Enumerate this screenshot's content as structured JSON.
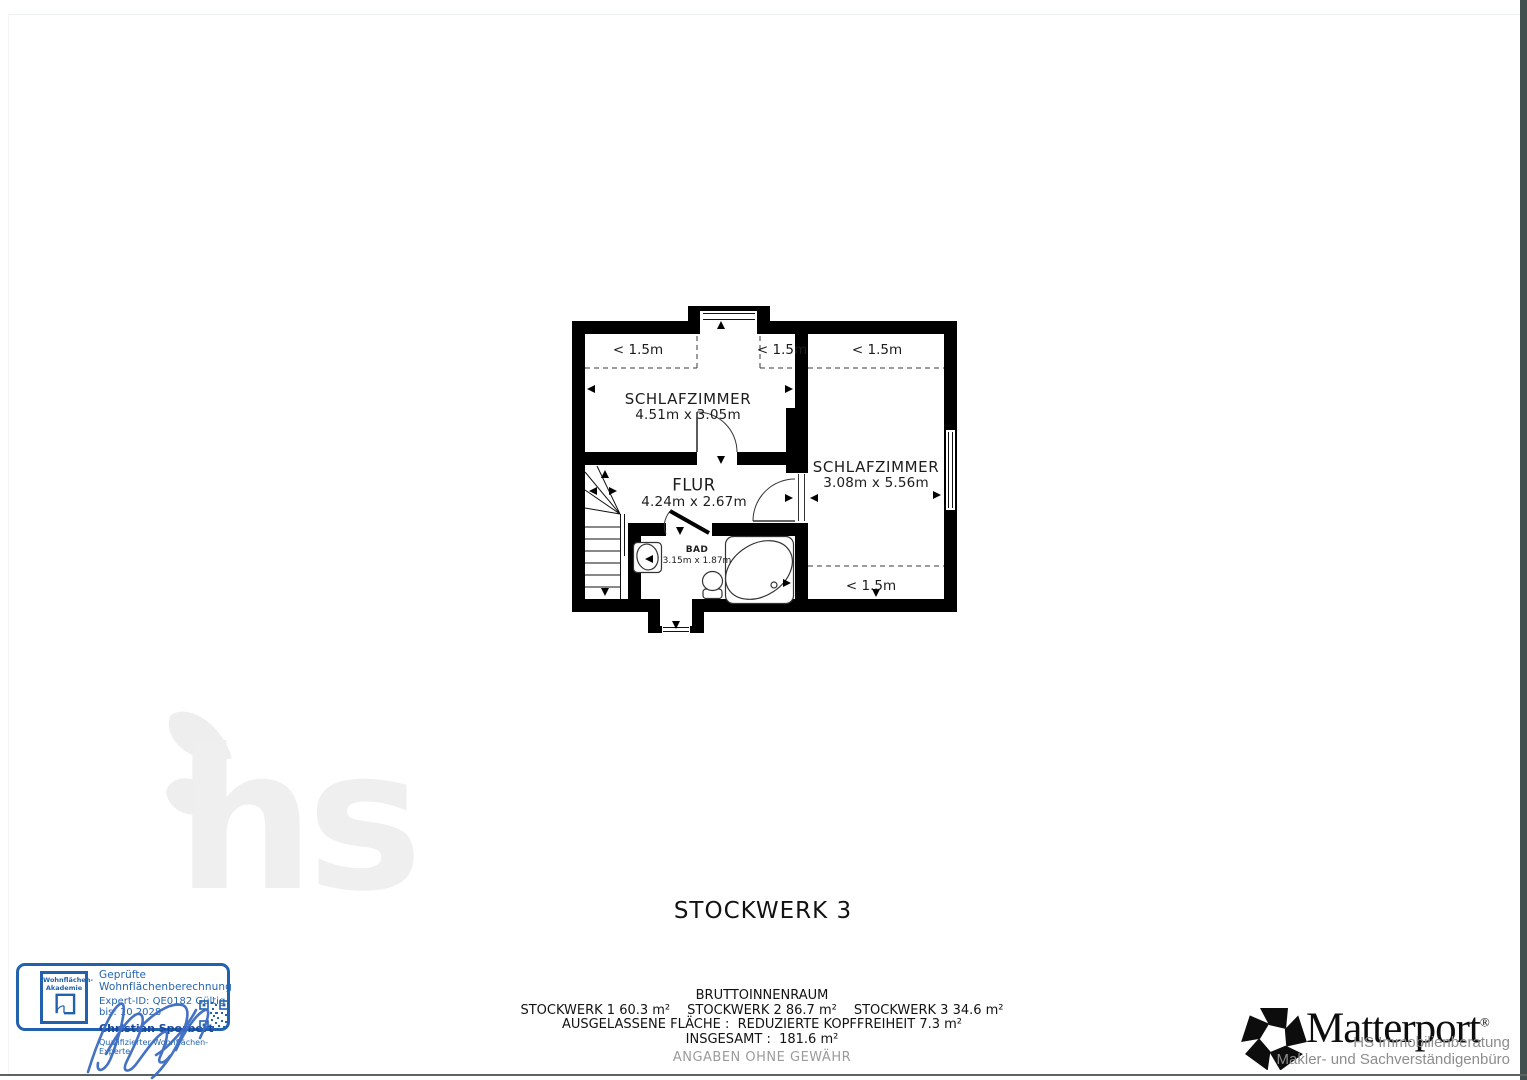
{
  "title": "STOCKWERK 3",
  "plan": {
    "rooms": [
      {
        "name": "SCHLAFZIMMER",
        "dims": "4.51m x 3.05m"
      },
      {
        "name": "SCHLAFZIMMER",
        "dims": "3.08m x 5.56m"
      },
      {
        "name": "FLUR",
        "dims": "4.24m x 2.67m"
      },
      {
        "name": "BAD",
        "dims": "3.15m x 1.87m"
      }
    ],
    "headroom_labels": [
      "< 1.5m",
      "< 1.5m",
      "< 1.5m",
      "< 1.5m"
    ]
  },
  "summary": {
    "heading": "BRUTTOINNENRAUM",
    "floors": [
      "STOCKWERK 1 60.3 m²",
      "STOCKWERK 2 86.7 m²",
      "STOCKWERK 3 34.6 m²"
    ],
    "excluded": "AUSGELASSENE FLÄCHE :  REDUZIERTE KOPFFREIHEIT 7.3 m²",
    "total": "INSGESAMT :  181.6 m²",
    "disclaimer": "ANGABEN OHNE GEWÄHR"
  },
  "certification": {
    "badge_line1": "Wohnflächen-",
    "badge_line2": "Akademie",
    "title": "Geprüfte Wohnflächenberechnung",
    "id_line": "Expert-ID: QE0182  Gültig bis: 10.2028",
    "name": "Christian Sporbert",
    "role": "Qualifizierter Wohnflächen-Experte"
  },
  "branding": {
    "wordmark": "Matterport",
    "registered": "®",
    "company_line1": "HS Immobilienberatung",
    "company_line2": "Makler- und Sachverständigenbüro"
  },
  "watermark_text": "hs",
  "colors": {
    "wall_black": "#000000",
    "stamp_blue": "#2161ae",
    "signature_blue": "#3b6ac2",
    "disclaimer_gray": "#9b9b9b",
    "brand_gray": "#8d8d8d",
    "watermark_gray": "#efefef"
  }
}
